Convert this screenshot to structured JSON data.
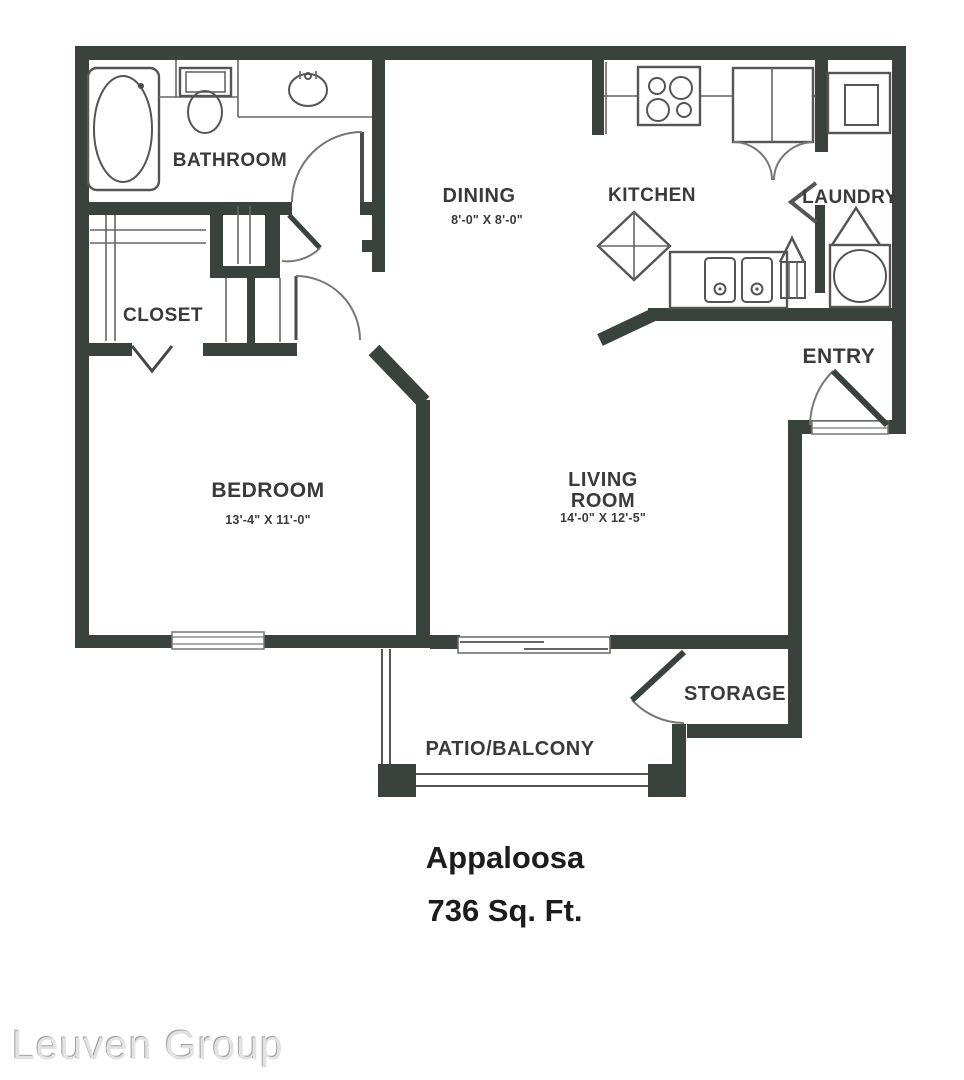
{
  "plan": {
    "title": "Appaloosa",
    "area": "736 Sq. Ft."
  },
  "watermark": "Leuven Group",
  "rooms": {
    "bathroom": {
      "label": "BATHROOM"
    },
    "closet": {
      "label": "CLOSET"
    },
    "dining": {
      "label": "DINING",
      "dims": "8'-0\" X 8'-0\""
    },
    "kitchen": {
      "label": "KITCHEN"
    },
    "laundry": {
      "label": "LAUNDRY"
    },
    "entry": {
      "label": "ENTRY"
    },
    "bedroom": {
      "label": "BEDROOM",
      "dims": "13'-4\" X 11'-0\""
    },
    "living_room": {
      "label_line1": "LIVING",
      "label_line2": "ROOM",
      "dims": "14'-0\" X 12'-5\""
    },
    "storage": {
      "label": "STORAGE"
    },
    "patio": {
      "label": "PATIO/BALCONY"
    }
  },
  "colors": {
    "wall": "#3a423e",
    "fixture_line": "#555555",
    "door_arc": "#777777",
    "label_text": "#3a3a3a",
    "title_text": "#1c1c1c",
    "watermark_text": "#e2e2e2"
  }
}
